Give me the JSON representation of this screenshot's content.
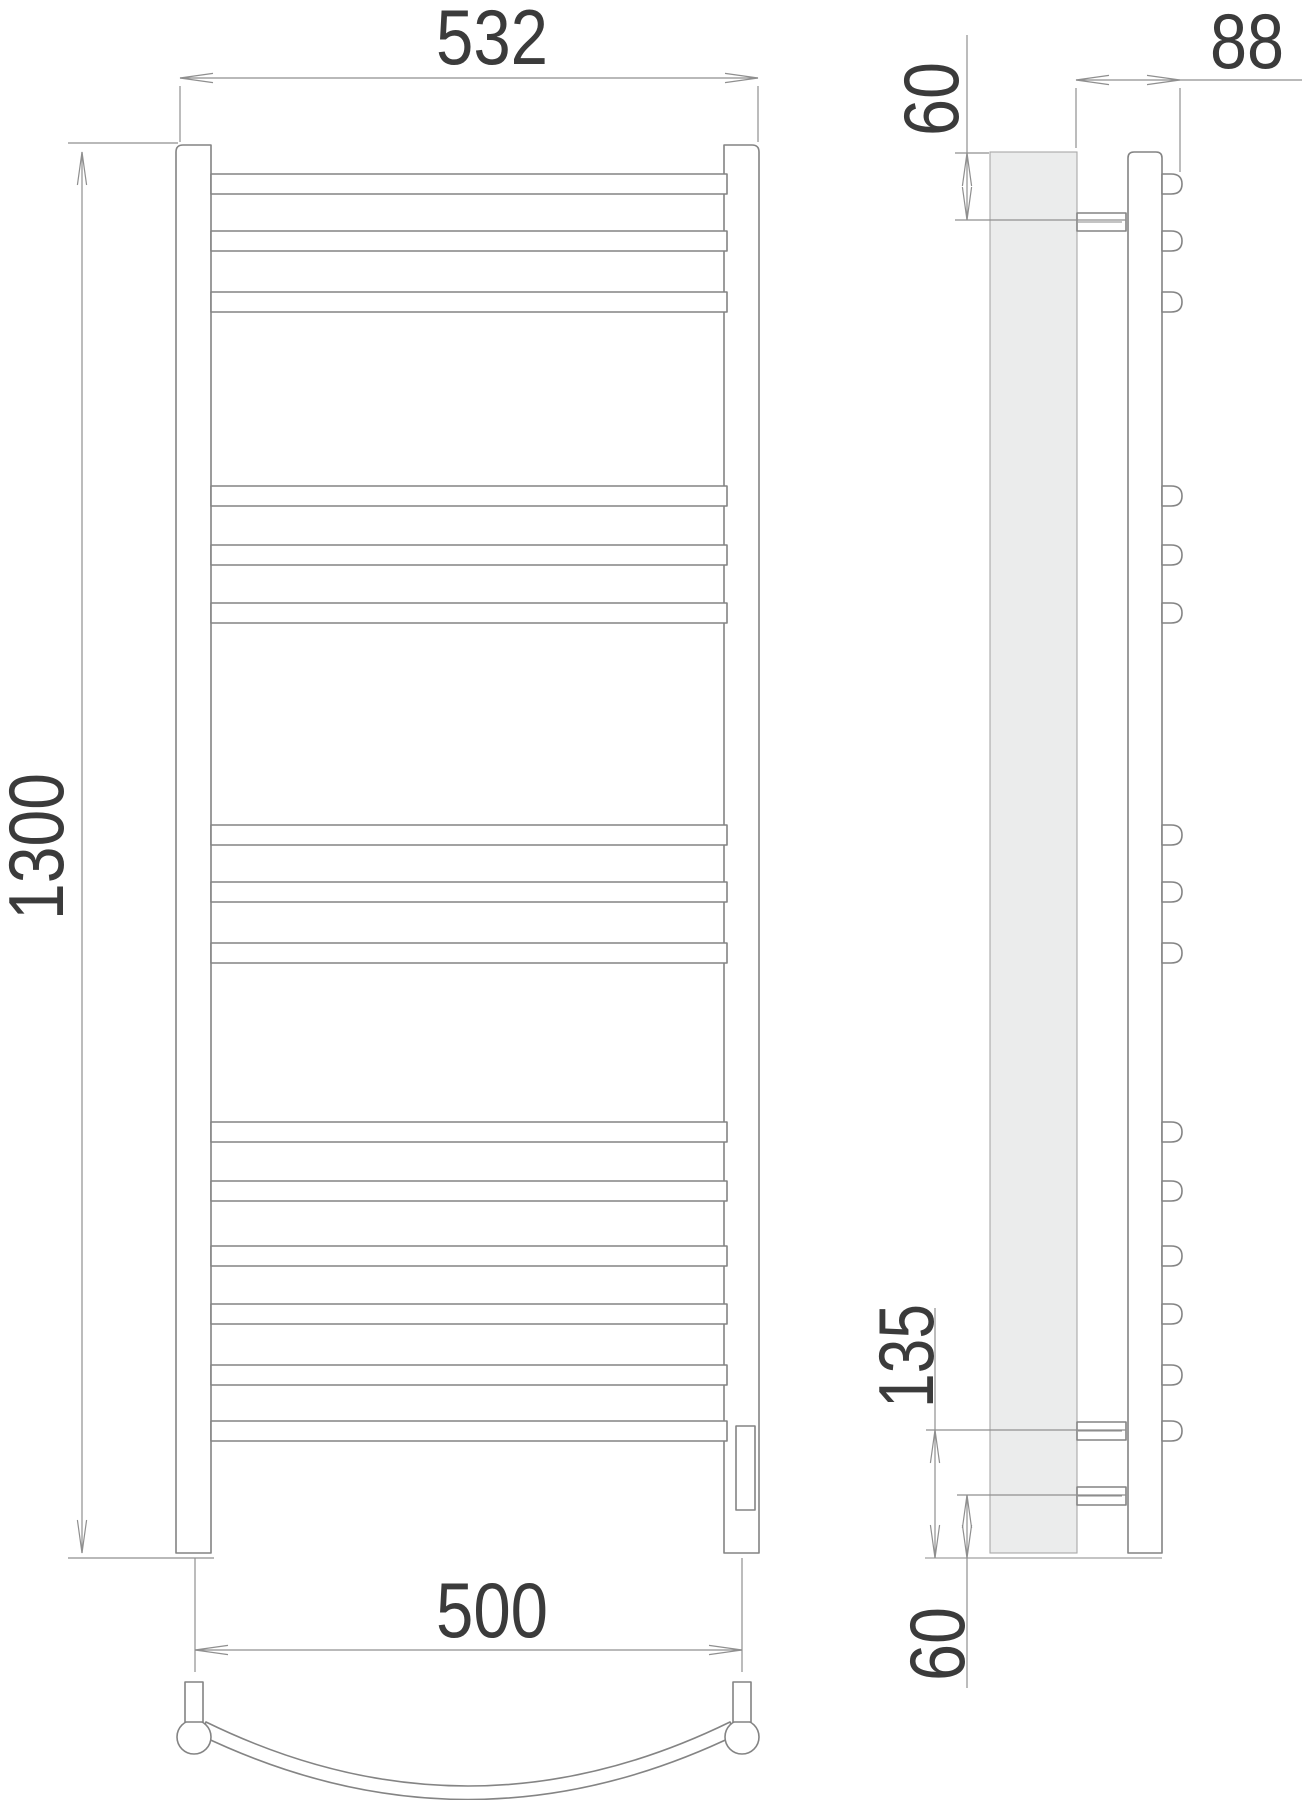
{
  "palette": {
    "background": "#ffffff",
    "outline": "#848484",
    "dim_line": "#8f8f8f",
    "text": "#3b3b3b",
    "wall_fill": "#ebecec",
    "wall_stroke": "#a8a8a8"
  },
  "dims": {
    "front_width_top": "532",
    "front_height": "1300",
    "front_width_bottom": "500",
    "side_depth": "88",
    "side_top_offset": "60",
    "side_mid_offset": "135",
    "side_bottom_offset": "60"
  },
  "front_view": {
    "rail_top_y": 145,
    "rail_bottom_y": 1553,
    "left_rail": {
      "x": 176,
      "w": 35
    },
    "right_rail": {
      "x": 724,
      "w": 35
    },
    "rungs": {
      "x": 211,
      "len": 516,
      "h": 20,
      "tops": [
        174,
        231,
        292,
        486,
        545,
        603,
        825,
        882,
        943,
        1122,
        1181,
        1246,
        1304,
        1365,
        1421
      ]
    },
    "heater_box": {
      "x": 736,
      "y": 1426,
      "w": 19,
      "h": 84
    },
    "shelf": {
      "stub_y": 1682,
      "stub_w": 18,
      "stub_h": 40,
      "stub_x": [
        185,
        733
      ],
      "feet_cx": [
        194,
        742
      ],
      "feet_cy": 1737,
      "feet_r": 17,
      "band_path": "M206,1722 Q468,1850 730,1722 L736,1735 Q468,1864 200,1735 Z"
    }
  },
  "side_view": {
    "wall": {
      "x": 990,
      "y": 152,
      "w": 87,
      "h": 1401
    },
    "rail": {
      "x": 1128,
      "y": 152,
      "w": 34,
      "h": 1401
    },
    "bumps": {
      "x": 1162,
      "w": 20,
      "h": 20
    },
    "brackets": {
      "x": 1077,
      "w": 49,
      "h": 18,
      "tops": [
        213,
        1422,
        1487
      ]
    },
    "baseline": {
      "y": 1558,
      "x1": 925,
      "x2": 1162
    }
  },
  "dim_specs": [
    {
      "bind": "dims.front_width_top",
      "name": "dim-front-width-top",
      "lines": [
        [
          180,
          78,
          758,
          78
        ]
      ],
      "exts": [
        [
          180,
          86,
          180,
          142
        ],
        [
          758,
          86,
          758,
          142
        ]
      ],
      "arrows": [
        [
          "left",
          180,
          78
        ],
        [
          "right",
          758,
          78
        ]
      ],
      "text": {
        "x": 492,
        "y": 64,
        "len": 112,
        "rot": false
      }
    },
    {
      "bind": "dims.front_height",
      "name": "dim-front-height",
      "lines": [
        [
          82,
          152,
          82,
          1553
        ]
      ],
      "exts": [
        [
          68,
          143,
          178,
          143
        ],
        [
          68,
          1558,
          214,
          1558
        ]
      ],
      "arrows": [
        [
          "up",
          82,
          152
        ],
        [
          "down",
          82,
          1553
        ]
      ],
      "text": {
        "x": 63,
        "y": 920,
        "len": 147,
        "rot": true
      }
    },
    {
      "bind": "dims.front_width_bottom",
      "name": "dim-front-width-bottom",
      "lines": [
        [
          195,
          1650,
          742,
          1650
        ]
      ],
      "exts": [
        [
          195,
          1558,
          195,
          1672
        ],
        [
          742,
          1558,
          742,
          1672
        ]
      ],
      "arrows": [
        [
          "left",
          195,
          1650
        ],
        [
          "right",
          742,
          1650
        ]
      ],
      "text": {
        "x": 492,
        "y": 1637,
        "len": 112,
        "rot": false
      }
    },
    {
      "bind": "dims.side_depth",
      "name": "dim-side-depth",
      "lines": [
        [
          1076,
          80,
          1302,
          80
        ]
      ],
      "exts": [
        [
          1076,
          88,
          1076,
          148
        ],
        [
          1180,
          88,
          1180,
          172
        ]
      ],
      "arrows": [
        [
          "left",
          1076,
          80
        ],
        [
          "right",
          1180,
          80
        ]
      ],
      "text": {
        "x": 1247,
        "y": 68,
        "len": 74,
        "rot": false
      }
    },
    {
      "bind": "dims.side_top_offset",
      "name": "dim-side-top-offset",
      "lines": [
        [
          967,
          35,
          967,
          220
        ]
      ],
      "exts": [
        [
          955,
          153,
          989,
          153
        ],
        [
          955,
          220,
          1126,
          220
        ]
      ],
      "arrows": [
        [
          "up",
          967,
          153
        ],
        [
          "down",
          967,
          220
        ]
      ],
      "text": {
        "x": 958,
        "y": 136,
        "len": 74,
        "rot": true
      }
    },
    {
      "bind": "dims.side_mid_offset",
      "name": "dim-side-mid-offset",
      "lines": [
        [
          935,
          1308,
          935,
          1558
        ]
      ],
      "exts": [
        [
          926,
          1430,
          1126,
          1430
        ]
      ],
      "arrows": [
        [
          "up",
          935,
          1430
        ],
        [
          "down",
          935,
          1558
        ]
      ],
      "text": {
        "x": 933,
        "y": 1408,
        "len": 104,
        "rot": true
      }
    },
    {
      "bind": "dims.side_bottom_offset",
      "name": "dim-side-bottom-offset",
      "lines": [
        [
          967,
          1495,
          967,
          1688
        ]
      ],
      "exts": [
        [
          957,
          1495,
          1126,
          1495
        ]
      ],
      "arrows": [
        [
          "up",
          967,
          1495
        ],
        [
          "down",
          967,
          1558
        ]
      ],
      "text": {
        "x": 964,
        "y": 1681,
        "len": 74,
        "rot": true
      }
    }
  ]
}
